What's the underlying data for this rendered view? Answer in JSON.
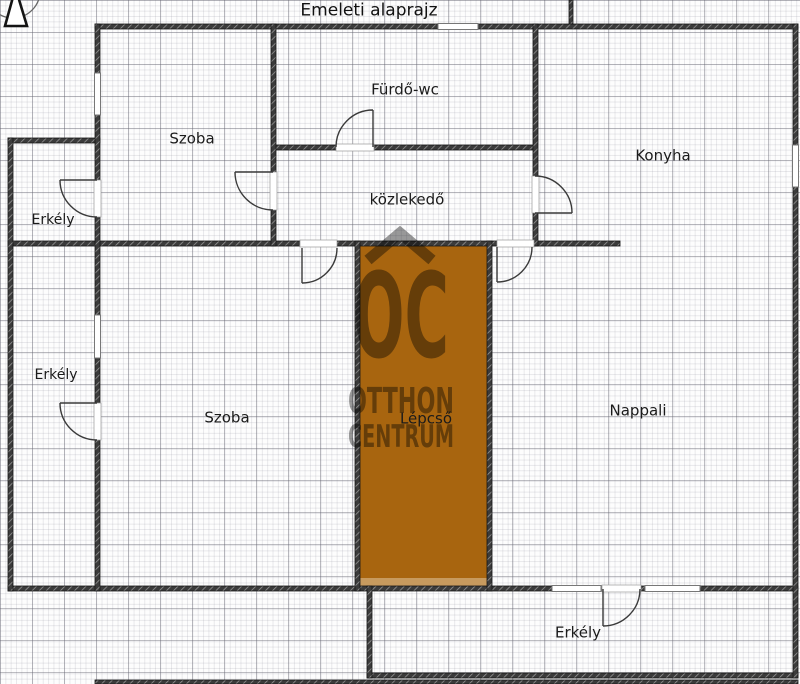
{
  "title": "Emeleti alaprajz",
  "rooms": {
    "szoba_top": {
      "name": "Szoba"
    },
    "furdo_wc": {
      "name": "Fürdő-wc"
    },
    "konyha": {
      "name": "Konyha"
    },
    "kozlekedo": {
      "name": "közlekedő"
    },
    "erkely_top": {
      "name": "Erkély"
    },
    "erkely_mid": {
      "name": "Erkély"
    },
    "szoba_lower": {
      "name": "Szoba"
    },
    "lepcso": {
      "name": "Lépcső"
    },
    "nappali": {
      "name": "Nappali"
    },
    "erkely_bottom": {
      "name": "Erkély"
    }
  },
  "watermark": {
    "monogram": "OC",
    "line1": "OTTHON",
    "line2": "CENTRUM"
  },
  "colors": {
    "staircase_fill": "#a8650f",
    "staircase_fill_light": "#c79a5e",
    "watermark_gray": "#999999",
    "wall_dark": "#3b3b3b"
  }
}
